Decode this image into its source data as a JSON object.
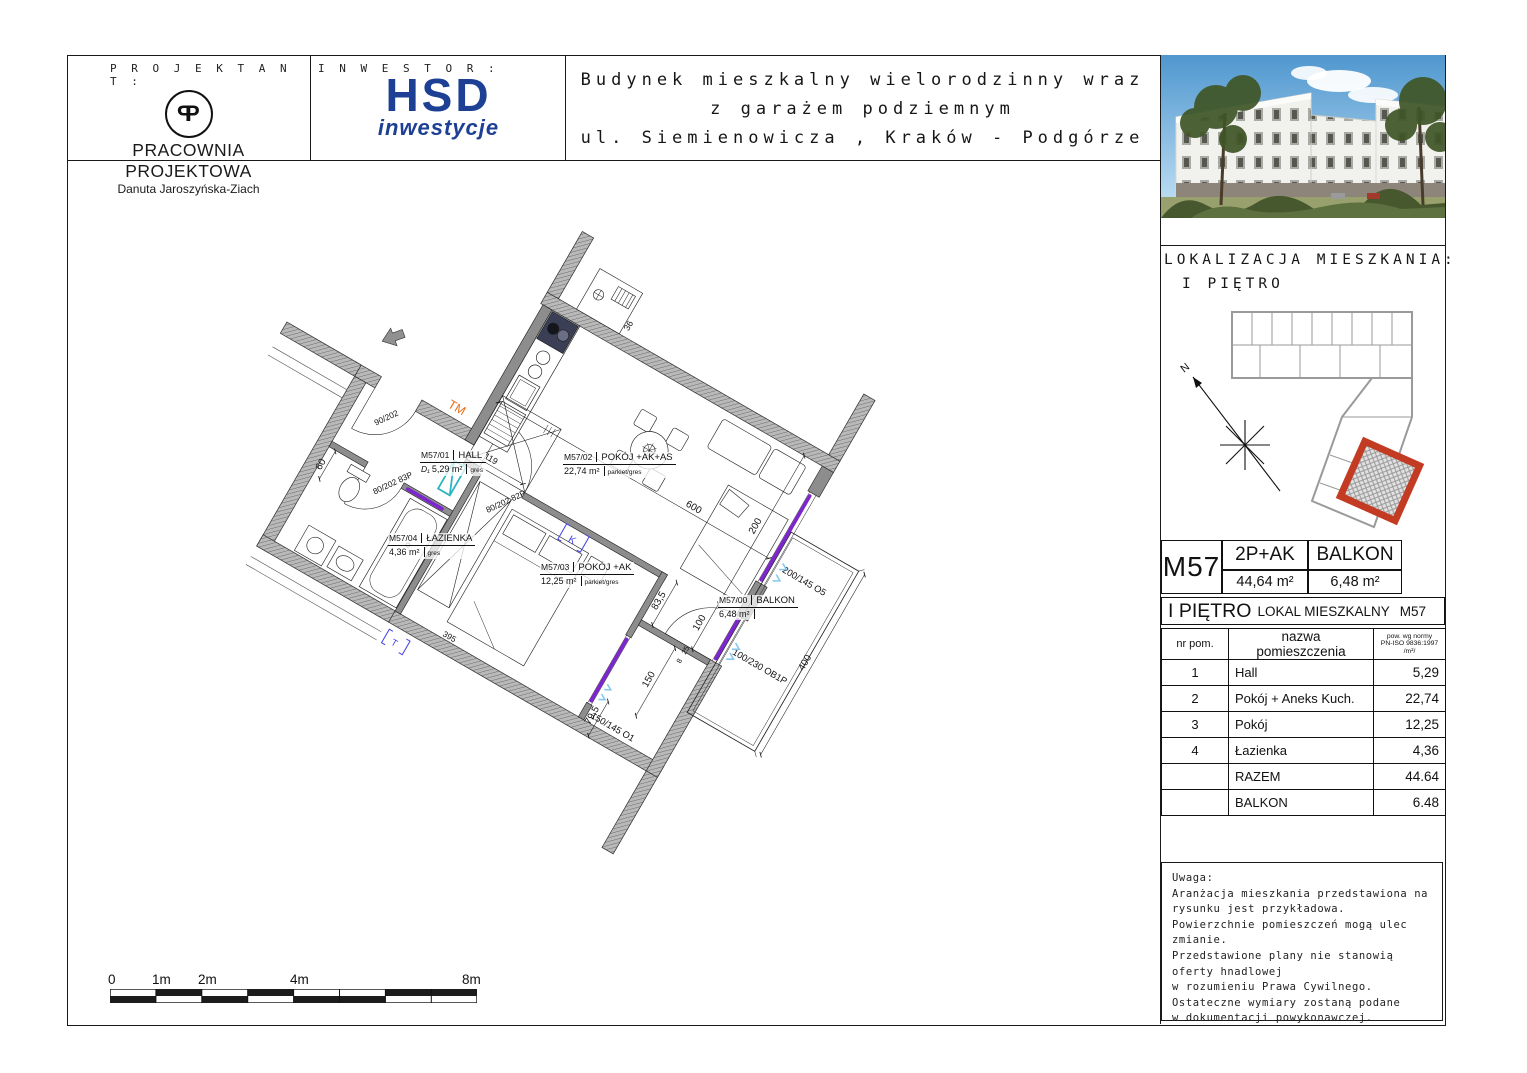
{
  "header": {
    "projektant_label": "P R O J E K T A N T :",
    "studio": "PRACOWNIA PROJEKTOWA",
    "person": "Danuta Jaroszyńska-Ziach",
    "logo_letters": "P",
    "inwestor_label": "I N W E S T O R :",
    "brand": "HSD",
    "brand_sub": "inwestycje",
    "title_lines": [
      "Budynek mieszkalny wielorodzinny wraz",
      "z garażem podziemnym",
      "ul. Siemienowicza , Kraków - Podgórze"
    ]
  },
  "location": {
    "heading": "LOKALIZACJA MIESZKANIA:",
    "floor": "I PIĘTRO",
    "north": "N"
  },
  "summary": {
    "unit": "M57",
    "type": "2P+AK",
    "type_area": "44,64 m²",
    "balkon": "BALKON",
    "balkon_area": "6,48 m²"
  },
  "unit_row": {
    "floor": "I PIĘTRO",
    "label": "LOKAL MIESZKALNY",
    "unit": "M57"
  },
  "rooms_table": {
    "col_nr": "nr pom.",
    "col_name": "nazwa pomieszczenia",
    "col_area_lines": [
      "pow. wg normy",
      "PN-ISO 9836:1997",
      "/m²/"
    ],
    "rows": [
      {
        "nr": "1",
        "name": "Hall",
        "area": "5,29"
      },
      {
        "nr": "2",
        "name": "Pokój + Aneks Kuch.",
        "area": "22,74"
      },
      {
        "nr": "3",
        "name": "Pokój",
        "area": "12,25"
      },
      {
        "nr": "4",
        "name": "Łazienka",
        "area": "4,36"
      },
      {
        "nr": "",
        "name": "RAZEM",
        "area": "44.64"
      },
      {
        "nr": "",
        "name": "BALKON",
        "area": "6.48"
      }
    ]
  },
  "note": {
    "lines": [
      "Uwaga:",
      "Aranżacja mieszkania przedstawiona na",
      "rysunku jest przykładowa.",
      "Powierzchnie pomieszczeń mogą ulec",
      "zmianie.",
      "Przedstawione plany nie stanowią",
      "oferty hnadlowej",
      "w rozumieniu Prawa Cywilnego.",
      "Ostateczne wymiary zostaną podane",
      "w dokumentacji powykonawczej."
    ]
  },
  "scale_bar": {
    "labels": [
      "0",
      "1m",
      "2m",
      "4m",
      "8m"
    ]
  },
  "plan": {
    "rooms": [
      {
        "id": "M57/01",
        "name": "HALL",
        "area": "5,29 m²",
        "floor": "gres"
      },
      {
        "id": "M57/02",
        "name": "POKÓJ +AK+AS",
        "area": "22,74 m²",
        "floor": "parkiet/gres"
      },
      {
        "id": "M57/03",
        "name": "POKÓJ +AK",
        "area": "12,25 m²",
        "floor": "parkiet/gres"
      },
      {
        "id": "M57/04",
        "name": "ŁAZIENKA",
        "area": "4,36 m²",
        "floor": "gres"
      },
      {
        "id": "M57/00",
        "name": "BALKON",
        "area": "6,48 m²",
        "floor": ""
      }
    ],
    "door_tag": "D₁",
    "dims": {
      "d600": "600",
      "d200": "200",
      "d400": "400",
      "d395": "395",
      "d150": "150",
      "d119": "119",
      "d36": "36",
      "d835": "83,5",
      "d795": "79,5",
      "d100": "100",
      "d60": "60",
      "d25": "25",
      "d8": "8"
    },
    "openings": {
      "o5": "200/145 O5",
      "ob1p": "100/230 OB1P",
      "o1": "150/145 O1",
      "d83p": "80/202 83P",
      "d82p": "80/202 82P",
      "d1": "90/202"
    },
    "marks": {
      "tm": "TM",
      "k": "K",
      "t": "T"
    }
  },
  "colors": {
    "accent_navy": "#1d3f94",
    "lintel_purple": "#7d26cd",
    "radiator_cyan": "#2ab5c3",
    "mark_orange": "#e8701a",
    "unit_red": "#c23b22"
  }
}
